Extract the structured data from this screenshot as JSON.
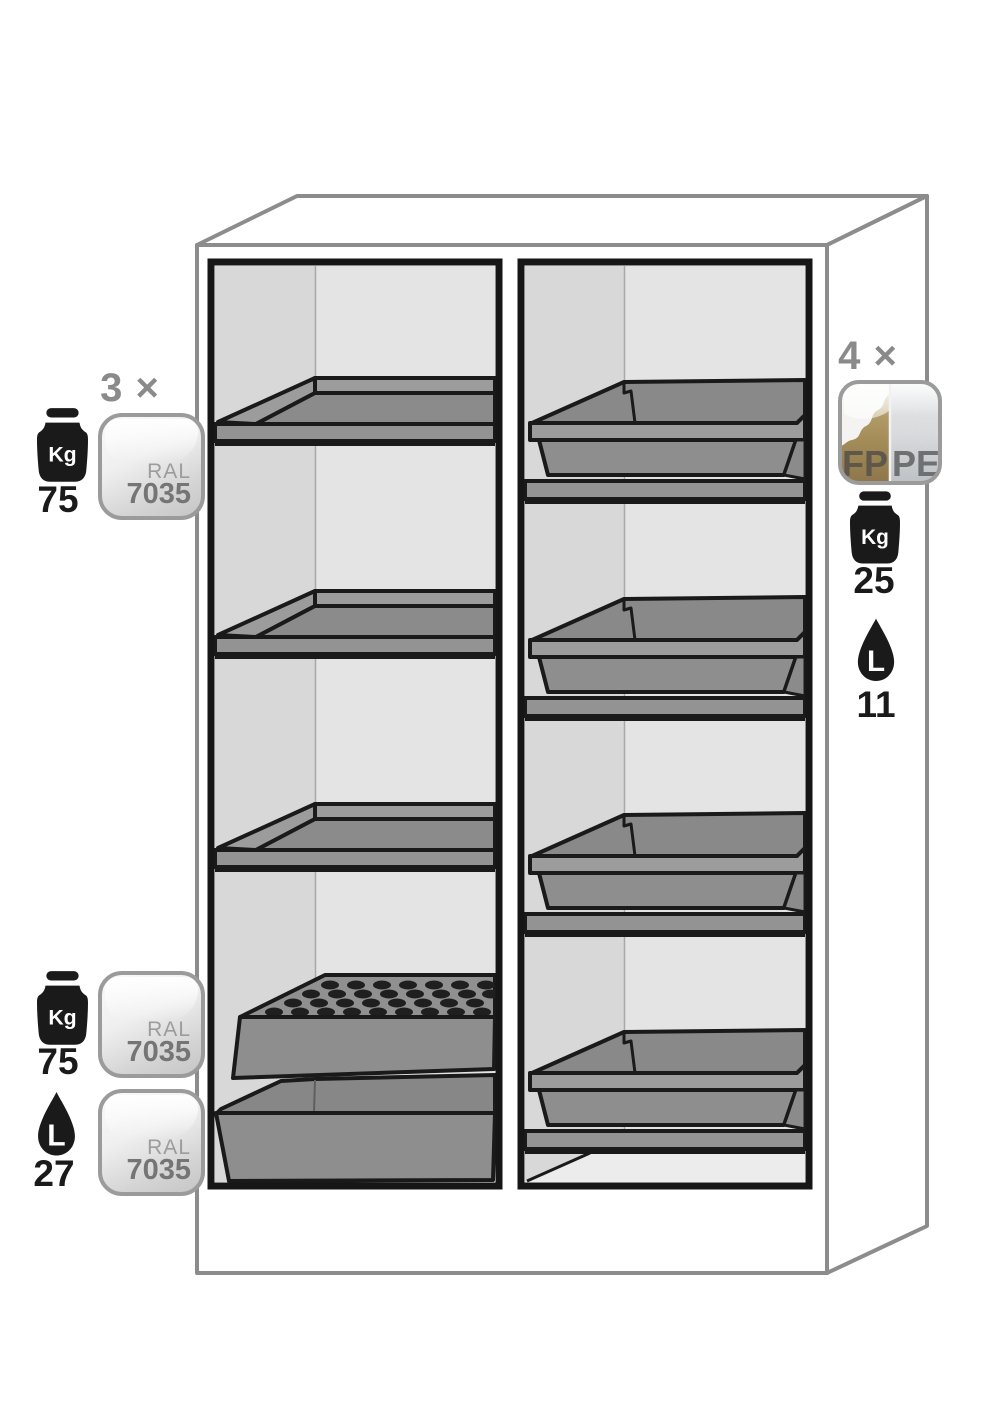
{
  "diagram": {
    "description": "Safety cabinet interior equipment diagram with two vertical compartments: left compartment with 3 shelves plus perforated insert over bottom sump, right compartment with 4 tray sumps on shelves"
  },
  "colors": {
    "outline_gray": "#8c8c8c",
    "frame_black": "#161616",
    "interior_side_wall": "#d8d8d8",
    "interior_back_wall": "#e4e4e4",
    "equipment_gray": "#8b8b8b",
    "equipment_light_gray": "#9c9c9c",
    "label_gray": "#8a8a8a",
    "text_black": "#1a1a1a",
    "ral_border": "#9b9b9b",
    "fp_gold": "#a58e59",
    "pe_gray": "#dfe1e3"
  },
  "annotations": {
    "left_top": {
      "count_label": "3 ×",
      "weight_icon_unit": "Kg",
      "weight_value": "75",
      "ral_badge": {
        "prefix": "RAL",
        "code": "7035"
      }
    },
    "left_bottom": {
      "weight_icon_unit": "Kg",
      "weight_value": "75",
      "ral_badge_upper": {
        "prefix": "RAL",
        "code": "7035"
      },
      "volume_icon_unit": "L",
      "volume_value": "27",
      "ral_badge_lower": {
        "prefix": "RAL",
        "code": "7035"
      }
    },
    "right": {
      "count_label": "4 ×",
      "material_badge": {
        "left": "FP",
        "right": "PE"
      },
      "weight_icon_unit": "Kg",
      "weight_value": "25",
      "volume_icon_unit": "L",
      "volume_value": "11"
    }
  }
}
